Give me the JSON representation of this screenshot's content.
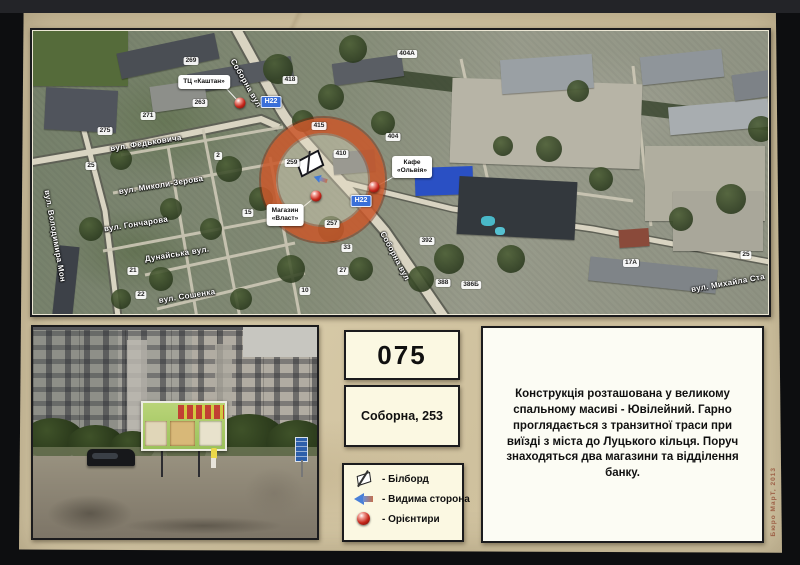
{
  "card": {
    "board_number": "075",
    "address": "Соборна, 253",
    "description": "Конструкція розташована у великому спальному масиві - Ювілейний. Гарно проглядається з транзитної траси при виїзді з міста до Луцького кільця. Поруч знаходяться два магазини та відділення банку.",
    "watermark": "Бюро МарТ, 2013",
    "legend": [
      {
        "icon": "billboard-icon",
        "label": "- Білборд"
      },
      {
        "icon": "arrow-icon",
        "label": "- Видима сторона"
      },
      {
        "icon": "sphere-icon",
        "label": "- Орієнтири"
      }
    ]
  },
  "map": {
    "colors": {
      "road_badge": "#3a6fd8",
      "target_ring": "#c54a1b"
    },
    "road_badges": [
      {
        "text": "Н22",
        "x": 238,
        "y": 71
      },
      {
        "text": "Н22",
        "x": 328,
        "y": 170
      }
    ],
    "street_labels": [
      {
        "text": "Соборна вул",
        "x": 213,
        "y": 52,
        "r": 60
      },
      {
        "text": "Соборна вул",
        "x": 362,
        "y": 225,
        "r": 62
      },
      {
        "text": "вул. Федьковича",
        "x": 113,
        "y": 112,
        "r": -9
      },
      {
        "text": "вул. Миколи-Зерова",
        "x": 128,
        "y": 154,
        "r": -9
      },
      {
        "text": "вул. Гончарова",
        "x": 103,
        "y": 193,
        "r": -9
      },
      {
        "text": "Дунайська вул.",
        "x": 144,
        "y": 223,
        "r": -9
      },
      {
        "text": "вул. Сошенка",
        "x": 154,
        "y": 265,
        "r": -9
      },
      {
        "text": "вул. Володимира Мон",
        "x": 22,
        "y": 205,
        "r": 80
      },
      {
        "text": "вул. Михайла Ста",
        "x": 695,
        "y": 252,
        "r": -10
      }
    ],
    "poi_labels": [
      {
        "text": "ТЦ «Каштан»",
        "x": 171,
        "y": 51
      },
      {
        "text": "Кафе\n«Ольвія»",
        "x": 379,
        "y": 136
      },
      {
        "text": "Магазин\n«Власт»",
        "x": 252,
        "y": 184
      }
    ],
    "landmarks": [
      {
        "x": 207,
        "y": 72
      },
      {
        "x": 341,
        "y": 156
      },
      {
        "x": 283,
        "y": 165
      }
    ],
    "house_numbers": [
      {
        "text": "269",
        "x": 158,
        "y": 30
      },
      {
        "text": "263",
        "x": 167,
        "y": 72
      },
      {
        "text": "418",
        "x": 257,
        "y": 49
      },
      {
        "text": "404А",
        "x": 374,
        "y": 23
      },
      {
        "text": "404",
        "x": 360,
        "y": 106
      },
      {
        "text": "415",
        "x": 286,
        "y": 95
      },
      {
        "text": "410",
        "x": 308,
        "y": 123
      },
      {
        "text": "259",
        "x": 259,
        "y": 132
      },
      {
        "text": "257",
        "x": 299,
        "y": 193
      },
      {
        "text": "33",
        "x": 314,
        "y": 217
      },
      {
        "text": "27",
        "x": 310,
        "y": 240
      },
      {
        "text": "10",
        "x": 272,
        "y": 260
      },
      {
        "text": "15",
        "x": 215,
        "y": 182
      },
      {
        "text": "392",
        "x": 394,
        "y": 210
      },
      {
        "text": "388",
        "x": 410,
        "y": 252
      },
      {
        "text": "386Б",
        "x": 438,
        "y": 254
      },
      {
        "text": "271",
        "x": 115,
        "y": 85
      },
      {
        "text": "275",
        "x": 72,
        "y": 100
      },
      {
        "text": "25",
        "x": 58,
        "y": 135
      },
      {
        "text": "2",
        "x": 185,
        "y": 125
      },
      {
        "text": "21",
        "x": 100,
        "y": 240
      },
      {
        "text": "22",
        "x": 108,
        "y": 264
      },
      {
        "text": "25",
        "x": 713,
        "y": 224
      },
      {
        "text": "17А",
        "x": 598,
        "y": 232
      }
    ]
  }
}
